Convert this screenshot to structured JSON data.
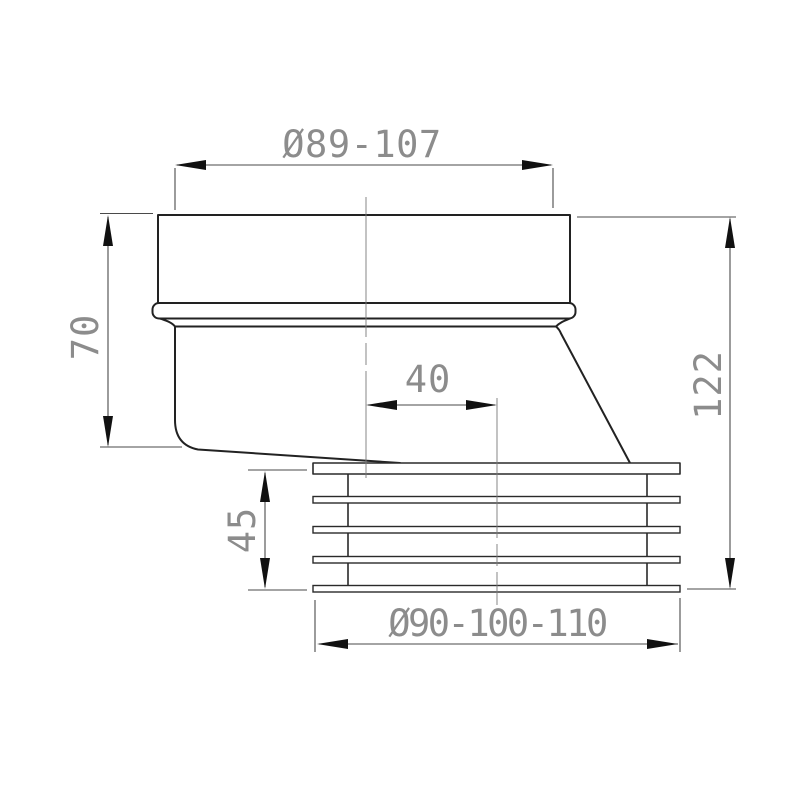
{
  "drawing": {
    "title": "Offset WC pan connector - dimensioned technical drawing",
    "units": "mm",
    "dimensions": {
      "top_diameter": {
        "label": "Ø89-107",
        "meaning": "inlet diameter range"
      },
      "left_height": {
        "label": "70",
        "meaning": "upper body height"
      },
      "offset": {
        "label": "40",
        "meaning": "centerline offset"
      },
      "total_height": {
        "label": "122",
        "meaning": "overall height"
      },
      "seal_height": {
        "label": "45",
        "meaning": "ribbed seal height"
      },
      "bottom_diameter": {
        "label": "Ø90-100-110",
        "meaning": "outlet diameter range"
      }
    },
    "colors": {
      "background": "#ffffff",
      "part_outline": "#222222",
      "dimension_lines": "#4a4a4a",
      "dimension_text": "#8c8c8c",
      "arrowheads": "#111111",
      "centerlines": "#7a7a7a"
    }
  }
}
